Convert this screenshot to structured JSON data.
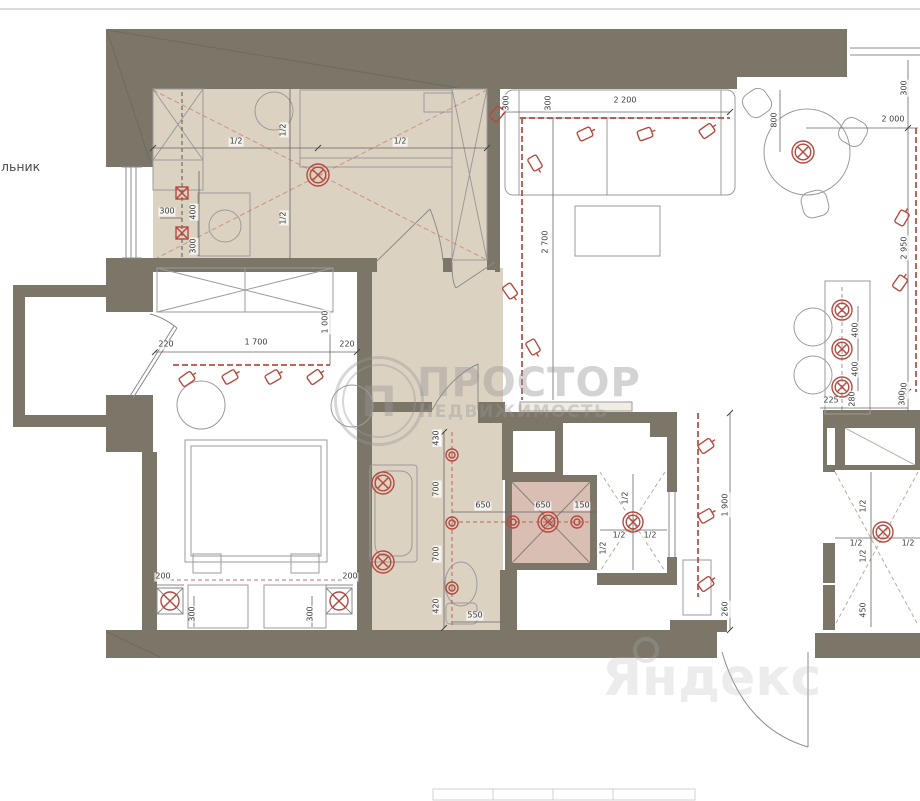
{
  "note_left": "льник",
  "watermark": {
    "brand": "ПРОСТОР",
    "subtitle": "НЕДВИЖИМОСТЬ",
    "logo_letter": "П"
  },
  "map_watermark": {
    "brand": "Яндекс"
  },
  "colors": {
    "wall": "#7c7669",
    "floor": "#dcd2c2",
    "shower_floor": "#d9beb4",
    "accent": "#b5493f"
  },
  "dimension_labels": [
    {
      "t": "1/2",
      "x": 236,
      "y": 142
    },
    {
      "t": "1/2",
      "x": 400,
      "y": 142
    },
    {
      "t": "1/2",
      "x": 284,
      "y": 130,
      "r": 1
    },
    {
      "t": "1/2",
      "x": 284,
      "y": 218,
      "r": 1
    },
    {
      "t": "300",
      "x": 167,
      "y": 212
    },
    {
      "t": "400",
      "x": 194,
      "y": 212,
      "r": 1
    },
    {
      "t": "300",
      "x": 194,
      "y": 246,
      "r": 1
    },
    {
      "t": "300",
      "x": 507,
      "y": 103,
      "r": 1
    },
    {
      "t": "300",
      "x": 549,
      "y": 103,
      "r": 1
    },
    {
      "t": "2 200",
      "x": 625,
      "y": 101
    },
    {
      "t": "2 700",
      "x": 546,
      "y": 242,
      "r": 1
    },
    {
      "t": "800",
      "x": 775,
      "y": 120,
      "r": 1
    },
    {
      "t": "2 000",
      "x": 893,
      "y": 120
    },
    {
      "t": "300",
      "x": 905,
      "y": 88,
      "r": 1
    },
    {
      "t": "2 950",
      "x": 905,
      "y": 248,
      "r": 1
    },
    {
      "t": "300",
      "x": 905,
      "y": 390,
      "r": 1
    },
    {
      "t": "400",
      "x": 856,
      "y": 330,
      "r": 1
    },
    {
      "t": "400",
      "x": 856,
      "y": 369,
      "r": 1
    },
    {
      "t": "225",
      "x": 831,
      "y": 401
    },
    {
      "t": "280",
      "x": 853,
      "y": 399,
      "r": 1
    },
    {
      "t": "300",
      "x": 903,
      "y": 398,
      "r": 1
    },
    {
      "t": "220",
      "x": 166,
      "y": 345
    },
    {
      "t": "1 700",
      "x": 256,
      "y": 343
    },
    {
      "t": "220",
      "x": 347,
      "y": 345
    },
    {
      "t": "1 000",
      "x": 326,
      "y": 322,
      "r": 1
    },
    {
      "t": "200",
      "x": 163,
      "y": 577
    },
    {
      "t": "200",
      "x": 350,
      "y": 577
    },
    {
      "t": "300",
      "x": 193,
      "y": 614,
      "r": 1
    },
    {
      "t": "300",
      "x": 311,
      "y": 614,
      "r": 1
    },
    {
      "t": "420",
      "x": 437,
      "y": 438,
      "r": 1
    },
    {
      "t": "700",
      "x": 437,
      "y": 489,
      "r": 1
    },
    {
      "t": "700",
      "x": 437,
      "y": 554,
      "r": 1
    },
    {
      "t": "420",
      "x": 437,
      "y": 606,
      "r": 1
    },
    {
      "t": "650",
      "x": 483,
      "y": 506
    },
    {
      "t": "650",
      "x": 543,
      "y": 506
    },
    {
      "t": "150",
      "x": 582,
      "y": 506
    },
    {
      "t": "550",
      "x": 475,
      "y": 616
    },
    {
      "t": "1/2",
      "x": 626,
      "y": 498,
      "r": 1
    },
    {
      "t": "1/2",
      "x": 619,
      "y": 536
    },
    {
      "t": "1/2",
      "x": 650,
      "y": 536
    },
    {
      "t": "1/2",
      "x": 604,
      "y": 548,
      "r": 1
    },
    {
      "t": "1 900",
      "x": 726,
      "y": 505,
      "r": 1
    },
    {
      "t": "260",
      "x": 726,
      "y": 609,
      "r": 1
    },
    {
      "t": "1/2",
      "x": 864,
      "y": 506,
      "r": 1
    },
    {
      "t": "1/2",
      "x": 856,
      "y": 544
    },
    {
      "t": "1/2",
      "x": 908,
      "y": 544
    },
    {
      "t": "1/2",
      "x": 864,
      "y": 556,
      "r": 1
    },
    {
      "t": "450",
      "x": 864,
      "y": 610,
      "r": 1
    },
    {
      "t": "430",
      "x": 437,
      "y": 438,
      "r": 1
    }
  ],
  "lights": {
    "ceiling": [
      {
        "x": 318,
        "y": 175
      },
      {
        "x": 803,
        "y": 152
      },
      {
        "x": 842,
        "y": 310,
        "d": 1
      },
      {
        "x": 842,
        "y": 349,
        "d": 1
      },
      {
        "x": 842,
        "y": 387,
        "d": 1
      },
      {
        "x": 383,
        "y": 483
      },
      {
        "x": 383,
        "y": 562
      },
      {
        "x": 548,
        "y": 522,
        "d": 1
      },
      {
        "x": 633,
        "y": 522,
        "d": 1
      },
      {
        "x": 883,
        "y": 532,
        "d": 1
      }
    ],
    "spots": [
      {
        "x": 585,
        "y": 134,
        "a": -25
      },
      {
        "x": 645,
        "y": 134,
        "a": -20
      },
      {
        "x": 707,
        "y": 131,
        "a": -35
      },
      {
        "x": 497,
        "y": 114,
        "a": -50
      },
      {
        "x": 535,
        "y": 163,
        "a": 60
      },
      {
        "x": 510,
        "y": 291,
        "a": 55
      },
      {
        "x": 533,
        "y": 347,
        "a": 60
      },
      {
        "x": 902,
        "y": 218,
        "a": -60
      },
      {
        "x": 900,
        "y": 283,
        "a": -55
      },
      {
        "x": 187,
        "y": 379,
        "a": -35
      },
      {
        "x": 230,
        "y": 377,
        "a": -30
      },
      {
        "x": 273,
        "y": 377,
        "a": -30
      },
      {
        "x": 315,
        "y": 377,
        "a": -35
      },
      {
        "x": 706,
        "y": 446,
        "a": -35
      },
      {
        "x": 706,
        "y": 516,
        "a": -30
      },
      {
        "x": 706,
        "y": 584,
        "a": -35
      }
    ],
    "donuts": [
      {
        "x": 452,
        "y": 455
      },
      {
        "x": 452,
        "y": 523
      },
      {
        "x": 452,
        "y": 588
      },
      {
        "x": 513,
        "y": 522
      },
      {
        "x": 577,
        "y": 522
      }
    ],
    "wall_boxes": [
      {
        "x": 182,
        "y": 193
      },
      {
        "x": 182,
        "y": 233
      }
    ],
    "corner": [
      {
        "x": 170,
        "y": 601
      },
      {
        "x": 339,
        "y": 601
      }
    ]
  }
}
